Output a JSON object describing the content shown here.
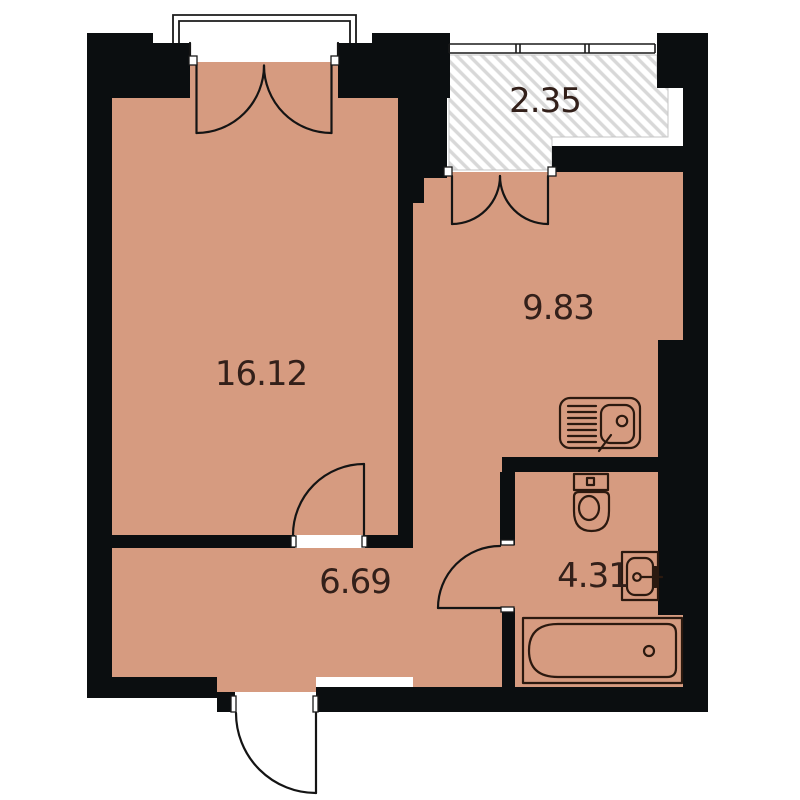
{
  "rooms": {
    "living": {
      "area": "16.12"
    },
    "kitchen": {
      "area": "9.83"
    },
    "balcony": {
      "area": "2.35"
    },
    "hallway": {
      "area": "6.69"
    },
    "bathroom": {
      "area": "4.31"
    }
  },
  "colors": {
    "bg": "#ffffff",
    "floor": "#d69b80",
    "wall": "#0b0e10",
    "hatch": "#d8d8d8",
    "line": "#2b190f",
    "door": "#141414",
    "text": "#33201a"
  }
}
